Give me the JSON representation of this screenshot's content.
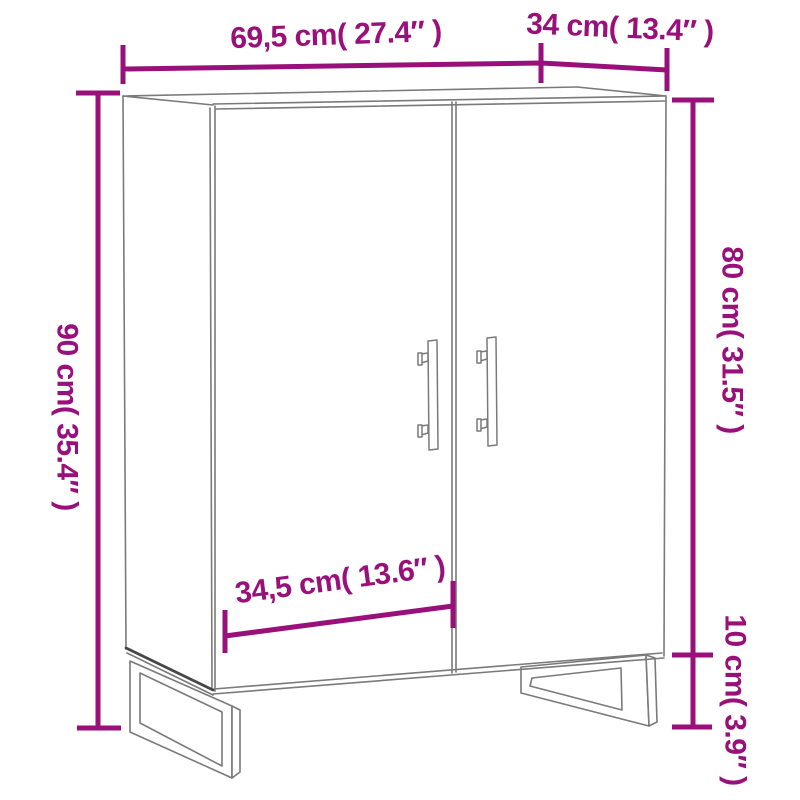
{
  "diagram": {
    "kind": "furniture-dimension-diagram",
    "subject": "two-door sideboard line drawing"
  },
  "colors": {
    "dimension": "#9A107A",
    "line_grey": "#7a7a7a",
    "line_dark": "#474747",
    "background": "#ffffff"
  },
  "dims": {
    "width": {
      "label": "69,5 cm( 27.4″ )"
    },
    "depth": {
      "label": "34 cm( 13.4″ )"
    },
    "height": {
      "label": "90 cm( 35.4″ )"
    },
    "body_height": {
      "label": "80 cm( 31.5″ )"
    },
    "leg_height": {
      "label": "10 cm( 3.9″ )"
    },
    "door_width": {
      "label": "34,5 cm( 13.6″ )"
    }
  }
}
